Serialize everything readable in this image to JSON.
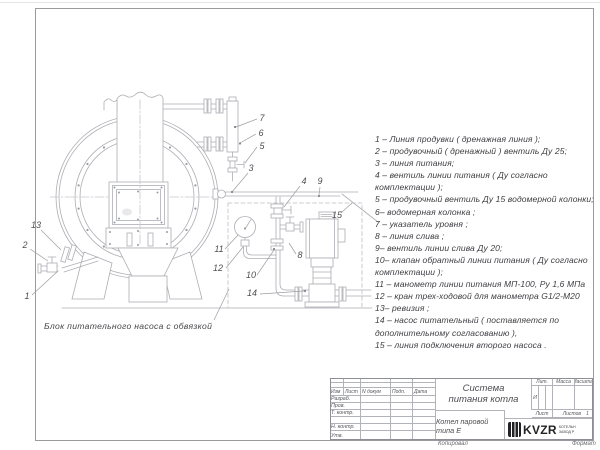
{
  "colors": {
    "line": "#adaeb4",
    "label": "#4e4f53",
    "list_text": "#3d3e42",
    "logo": "#232325"
  },
  "parts_list": {
    "items": [
      "1 –  Линия продувки  ( дренажная линия );",
      "2 –  продувочный  ( дренажный )  вентиль  Ду 25;",
      "3 –  линия питания;",
      "4 –  вентиль линии питания  ( Ду согласно комплектации );",
      "5 –  продувочный вентиль  Ду 15  водомерной колонки;",
      "6–  водомерная колонка ;",
      "7 –  указатель уровня ;",
      "8 –  линия слива ;",
      "9–  вентиль линии слива  Ду 20;",
      "10–  клапан обратный линии питания  ( Ду согласно комплектации );",
      "11 –  манометр линии питания  МП-100,  Ру  1,6  МПа",
      "12 –  кран трех-ходовой для манометра  G1/2-М20",
      "13–  ревизия ;",
      "14 –  насос питательный  ( поставляется по дополнительному согласованию ),",
      "15 –  линия подключения второго насоса ."
    ]
  },
  "drawing": {
    "caption": "Блок питательного насоса с обвязкой",
    "labels": [
      "1",
      "2",
      "3",
      "4",
      "5",
      "6",
      "7",
      "8",
      "9",
      "10",
      "11",
      "12",
      "13",
      "14",
      "15"
    ]
  },
  "title_block": {
    "doc_title_line1": "Система",
    "doc_title_line2": "питания котла",
    "product": "Котел паровой типа Е",
    "header_cols": [
      "Изм",
      "Лист",
      "N докум",
      "Подп.",
      "Дата"
    ],
    "row_labels": [
      "Разраб.",
      "Пров.",
      "Т. контр.",
      "",
      "Н. контр.",
      "Утв."
    ],
    "lit_label": "Лит.",
    "massa_label": "Масса",
    "masshtab_label": "Масштаб",
    "lit_value": "И",
    "list_label": "Лист",
    "listov_label": "Листов",
    "listov_value": "1",
    "logo_text": "KVZR",
    "logo_sub1": "КОТЕЛЬН",
    "logo_sub2": "ЗАВОД Р",
    "kopiroval": "Копировал",
    "format_label": "Формат"
  }
}
